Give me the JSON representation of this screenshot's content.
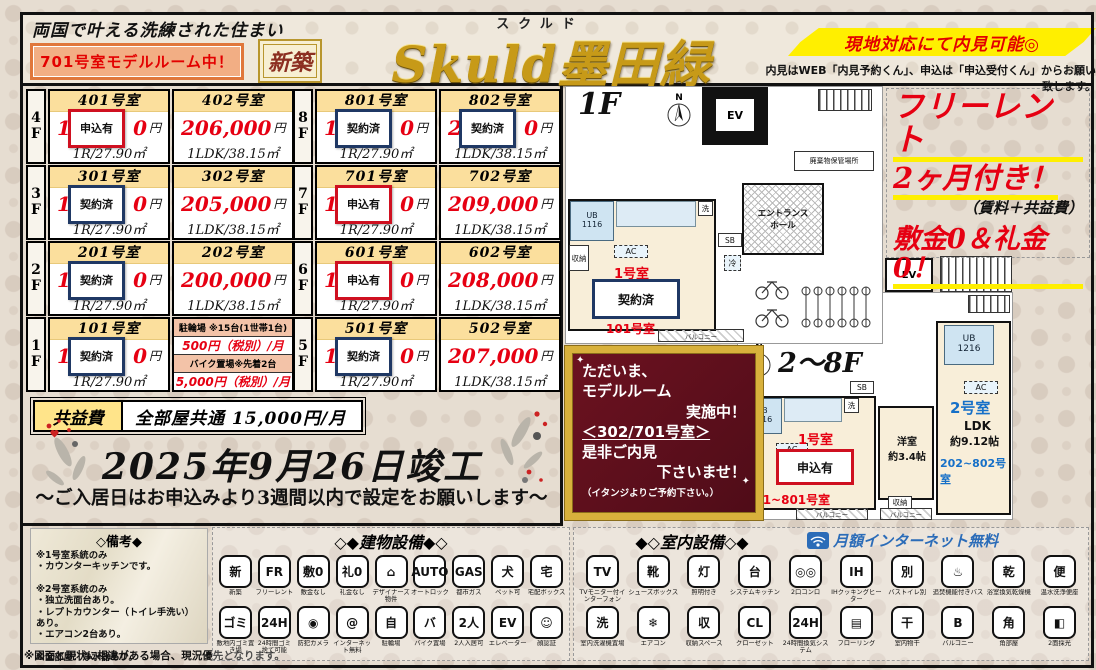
{
  "header": {
    "tagline": "両国で叶える洗練された住まい",
    "model_room_badge": "701号室モデルルーム中！",
    "new_badge": "新築",
    "title_furigana": "スクルド",
    "title": "Skuld墨田緑",
    "visit_highlight": "現地対応にて内見可能◎",
    "visit_note": "内見はWEB「内見予約くん」、申込は「申込受付くん」からお願い致します。"
  },
  "price_table": {
    "unit_yen": "円",
    "groups": [
      {
        "rows": [
          {
            "floor": "4F",
            "cells": [
              {
                "room": "401号室",
                "price_prefix": "14",
                "price_suffix": "0",
                "badge": "申込有",
                "badge_color": "red",
                "layout": "1R/27.90㎡"
              },
              {
                "room": "402号室",
                "price": "206,000",
                "layout": "1LDK/38.15㎡"
              }
            ]
          },
          {
            "floor": "3F",
            "cells": [
              {
                "room": "301号室",
                "price_prefix": "14",
                "price_suffix": "0",
                "badge": "契約済",
                "badge_color": "navy",
                "layout": "1R/27.90㎡"
              },
              {
                "room": "302号室",
                "price": "205,000",
                "layout": "1LDK/38.15㎡"
              }
            ]
          },
          {
            "floor": "2F",
            "cells": [
              {
                "room": "201号室",
                "price_prefix": "13",
                "price_suffix": "0",
                "badge": "契約済",
                "badge_color": "navy",
                "layout": "1R/27.90㎡"
              },
              {
                "room": "202号室",
                "price": "200,000",
                "layout": "1LDK/38.15㎡"
              }
            ]
          },
          {
            "floor": "1F",
            "cells": [
              {
                "room": "101号室",
                "price_prefix": "13",
                "price_suffix": "0",
                "badge": "契約済",
                "badge_color": "navy",
                "layout": "1R/27.90㎡"
              },
              {
                "parking": true,
                "h1": "駐輪場 ※15台(1世帯1台)",
                "p1": "500円（税別）/月",
                "h2": "バイク置場※先着2台",
                "p2": "5,000円（税別）/月"
              }
            ]
          }
        ]
      },
      {
        "rows": [
          {
            "floor": "8F",
            "cells": [
              {
                "room": "801号室",
                "price_prefix": "14",
                "price_suffix": "0",
                "badge": "契約済",
                "badge_color": "navy",
                "layout": "1R/27.90㎡"
              },
              {
                "room": "802号室",
                "price_prefix": "21",
                "price_suffix": "0",
                "badge": "契約済",
                "badge_color": "navy",
                "layout": "1LDK/38.15㎡"
              }
            ]
          },
          {
            "floor": "7F",
            "cells": [
              {
                "room": "701号室",
                "price_prefix": "14",
                "price_suffix": "0",
                "badge": "申込有",
                "badge_color": "red",
                "layout": "1R/27.90㎡"
              },
              {
                "room": "702号室",
                "price": "209,000",
                "layout": "1LDK/38.15㎡"
              }
            ]
          },
          {
            "floor": "6F",
            "cells": [
              {
                "room": "601号室",
                "price_prefix": "14",
                "price_suffix": "0",
                "badge": "申込有",
                "badge_color": "red",
                "layout": "1R/27.90㎡"
              },
              {
                "room": "602号室",
                "price": "208,000",
                "layout": "1LDK/38.15㎡"
              }
            ]
          },
          {
            "floor": "5F",
            "cells": [
              {
                "room": "501号室",
                "price_prefix": "14",
                "price_suffix": "0",
                "badge": "契約済",
                "badge_color": "navy",
                "layout": "1R/27.90㎡"
              },
              {
                "room": "502号室",
                "price": "207,000",
                "layout": "1LDK/38.15㎡"
              }
            ]
          }
        ]
      }
    ]
  },
  "fees": {
    "label": "共益費",
    "value": "全部屋共通 15,000円/月"
  },
  "completion": {
    "date": "2025年9月26日竣工",
    "note": "～ご入居日はお申込みより3週間以内で設定をお願いします～"
  },
  "promo": {
    "free_rent": "フリーレント",
    "free_rent2": "2ヶ月付き！",
    "note": "（賃料＋共益費）",
    "zero": "敷金0＆礼金0！"
  },
  "model_room_box": {
    "l1": "ただいま、",
    "l2": "モデルルーム",
    "l3": "実施中！",
    "l4": "＜302/701号室＞",
    "l5": "是非ご内見",
    "l6": "下さいませ！",
    "l7": "（イタンジよりご予約下さい。）"
  },
  "plan_1f": {
    "label": "1F",
    "north": "N",
    "ev": "EV",
    "waste": "廃棄物保管場所",
    "entrance": "エントランス\nホール",
    "ub": "UB\n1116",
    "storage": "収納",
    "ac": "AC",
    "sb": "SB",
    "cold": "冷",
    "wash": "洗",
    "unit": "1号室",
    "badge": "契約済",
    "room_no": "101号室",
    "balcony": "バルコニー"
  },
  "plan_28f": {
    "label": "2～8F",
    "north": "N",
    "ev": "EV",
    "ub1": "UB\n1116",
    "ub2": "UB\n1216",
    "sb": "SB",
    "ac": "AC",
    "wash": "洗",
    "storage": "収納",
    "unit1": "1号室",
    "badge1": "申込有",
    "rooms1": "201~801号室",
    "western": "洋室\n約3.4帖",
    "unit2": "2号室",
    "ldk": "LDK",
    "ldk_size": "約9.12帖",
    "rooms2": "202~802号室",
    "balcony": "バルコニー"
  },
  "remarks": {
    "title": "◇備考◆",
    "lines": [
      "※1号室系統のみ",
      "・カウンターキッチンです。",
      "",
      "※2号室系統のみ",
      "・独立洗面台あり。",
      "・レプトカウンター（トイレ手洗い）あり。",
      "・エアコン2台あり。",
      "",
      "※全部屋：浄水器あり。"
    ],
    "footer": "※図面と現状に相違がある場合、現況優先となります。"
  },
  "building_equipment": {
    "title": "◇◆建物設備◆◇",
    "row1": [
      {
        "label": "新築",
        "glyph": "新",
        "name": "new-construction"
      },
      {
        "label": "フリーレント",
        "glyph": "FR",
        "name": "free-rent"
      },
      {
        "label": "敷金なし",
        "glyph": "敷0",
        "name": "no-deposit"
      },
      {
        "label": "礼金なし",
        "glyph": "礼0",
        "name": "no-key-money"
      },
      {
        "label": "デザイナーズ物件",
        "glyph": "⌂",
        "name": "designer-property"
      },
      {
        "label": "オートロック",
        "glyph": "AUTO",
        "name": "auto-lock"
      },
      {
        "label": "都市ガス",
        "glyph": "GAS",
        "name": "city-gas"
      },
      {
        "label": "ペット可",
        "glyph": "犬",
        "name": "pets-allowed"
      },
      {
        "label": "宅配ボックス",
        "glyph": "宅",
        "name": "delivery-box"
      }
    ],
    "row2": [
      {
        "label": "敷地内ゴミ置き場",
        "glyph": "ゴミ",
        "name": "onsite-garbage-area"
      },
      {
        "label": "24時間ゴミ捨て可能",
        "glyph": "24H",
        "name": "24h-garbage-disposal"
      },
      {
        "label": "防犯カメラ",
        "glyph": "◉",
        "name": "security-camera"
      },
      {
        "label": "インターネット無料",
        "glyph": "@",
        "name": "free-internet"
      },
      {
        "label": "駐輪場",
        "glyph": "自",
        "name": "bicycle-parking"
      },
      {
        "label": "バイク置場",
        "glyph": "バ",
        "name": "motorbike-parking"
      },
      {
        "label": "2人入居可",
        "glyph": "2人",
        "name": "two-person-occupancy"
      },
      {
        "label": "エレベーター",
        "glyph": "EV",
        "name": "elevator"
      },
      {
        "label": "顔認証",
        "glyph": "☺",
        "name": "face-recognition"
      }
    ]
  },
  "indoor_equipment": {
    "title": "◆◇室内設備◇◆",
    "internet": "月額インターネット無料",
    "row1": [
      {
        "label": "TVモニター付インターフォン",
        "glyph": "TV",
        "name": "tv-monitor-intercom"
      },
      {
        "label": "シューズボックス",
        "glyph": "靴",
        "name": "shoe-box"
      },
      {
        "label": "照明付き",
        "glyph": "灯",
        "name": "lighting"
      },
      {
        "label": "システムキッチン",
        "glyph": "台",
        "name": "system-kitchen"
      },
      {
        "label": "2口コンロ",
        "glyph": "◎◎",
        "name": "two-burner-stove"
      },
      {
        "label": "IHクッキングヒーター",
        "glyph": "IH",
        "name": "ih-cooking-heater"
      },
      {
        "label": "バストイレ別",
        "glyph": "別",
        "name": "separate-bath-toilet"
      },
      {
        "label": "追焚機能付きバス",
        "glyph": "♨",
        "name": "reheating-bath"
      },
      {
        "label": "浴室換気乾燥機",
        "glyph": "乾",
        "name": "bathroom-ventilation-dryer"
      },
      {
        "label": "温水洗浄便座",
        "glyph": "便",
        "name": "washlet-toilet"
      }
    ],
    "row2": [
      {
        "label": "室内洗濯機置場",
        "glyph": "洗",
        "name": "indoor-washer-space"
      },
      {
        "label": "エアコン",
        "glyph": "❄",
        "name": "air-conditioner"
      },
      {
        "label": "収納スペース",
        "glyph": "収",
        "name": "storage-space"
      },
      {
        "label": "クローゼット",
        "glyph": "CL",
        "name": "closet"
      },
      {
        "label": "24時間換気システム",
        "glyph": "24H",
        "name": "24h-ventilation-system"
      },
      {
        "label": "フローリング",
        "glyph": "▤",
        "name": "flooring"
      },
      {
        "label": "室内物干",
        "glyph": "干",
        "name": "indoor-clothes-drying"
      },
      {
        "label": "バルコニー",
        "glyph": "B",
        "name": "balcony"
      },
      {
        "label": "角部屋",
        "glyph": "角",
        "name": "corner-room"
      },
      {
        "label": "2面採光",
        "glyph": "◧",
        "name": "dual-aspect-lighting"
      }
    ]
  }
}
